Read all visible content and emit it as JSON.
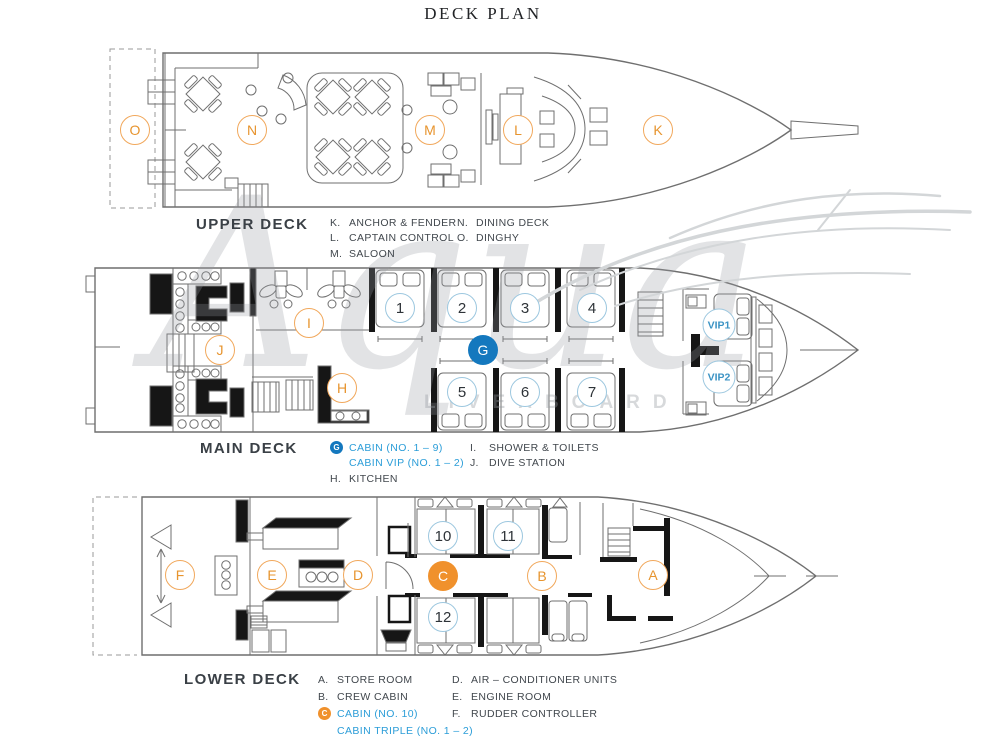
{
  "title": "DECK PLAN",
  "watermark": {
    "brand_script": "Aqua",
    "brand_caps": "LIVEABOARD"
  },
  "colors": {
    "orange_fill": "#F0912C",
    "orange_line": "#F1A85C",
    "orange_text": "#E7942E",
    "blue_fill": "#1478BE",
    "blue_line": "#9CC7DF",
    "blue_text": "#2B9DD8"
  },
  "decks": [
    {
      "id": "upper",
      "label": "UPPER DECK",
      "legend": [
        [
          {
            "key": "K.",
            "text": "ANCHOR & FENDER"
          },
          {
            "key": "L.",
            "text": "CAPTAIN CONTROL"
          },
          {
            "key": "M.",
            "text": "SALOON"
          }
        ],
        [
          {
            "key": "N.",
            "text": "DINING DECK"
          },
          {
            "key": "O.",
            "text": "DINGHY"
          }
        ]
      ],
      "markers": [
        {
          "label": "O",
          "x": 135,
          "y": 130,
          "style": "orange-outline"
        },
        {
          "label": "N",
          "x": 252,
          "y": 130,
          "style": "orange-outline"
        },
        {
          "label": "M",
          "x": 430,
          "y": 130,
          "style": "orange-outline"
        },
        {
          "label": "L",
          "x": 518,
          "y": 130,
          "style": "orange-outline"
        },
        {
          "label": "K",
          "x": 658,
          "y": 130,
          "style": "orange-outline"
        }
      ]
    },
    {
      "id": "main",
      "label": "MAIN DECK",
      "legend": [
        [
          {
            "icon": "G",
            "icon_style": "blue",
            "text": "CABIN (NO. 1 – 9)",
            "blue": true
          },
          {
            "text": "CABIN VIP (NO. 1 – 2)",
            "blue": true
          },
          {
            "key": "H.",
            "text": "KITCHEN"
          }
        ],
        [
          {
            "key": "I.",
            "text": "SHOWER & TOILETS"
          },
          {
            "key": "J.",
            "text": "DIVE STATION"
          }
        ]
      ],
      "markers": [
        {
          "label": "J",
          "x": 220,
          "y": 350,
          "style": "orange-outline"
        },
        {
          "label": "I",
          "x": 309,
          "y": 323,
          "style": "orange-outline"
        },
        {
          "label": "H",
          "x": 342,
          "y": 388,
          "style": "orange-outline"
        },
        {
          "label": "G",
          "x": 483,
          "y": 350,
          "style": "blue-filled"
        },
        {
          "label": "1",
          "x": 400,
          "y": 308,
          "style": "blue-outline"
        },
        {
          "label": "2",
          "x": 462,
          "y": 308,
          "style": "blue-outline"
        },
        {
          "label": "3",
          "x": 525,
          "y": 308,
          "style": "blue-outline"
        },
        {
          "label": "4",
          "x": 592,
          "y": 308,
          "style": "blue-outline"
        },
        {
          "label": "5",
          "x": 462,
          "y": 392,
          "style": "blue-outline"
        },
        {
          "label": "6",
          "x": 525,
          "y": 392,
          "style": "blue-outline"
        },
        {
          "label": "7",
          "x": 592,
          "y": 392,
          "style": "blue-outline"
        },
        {
          "label": "VIP1",
          "x": 719,
          "y": 325,
          "style": "vip"
        },
        {
          "label": "VIP2",
          "x": 719,
          "y": 377,
          "style": "vip"
        }
      ]
    },
    {
      "id": "lower",
      "label": "LOWER DECK",
      "legend": [
        [
          {
            "key": "A.",
            "text": "STORE ROOM"
          },
          {
            "key": "B.",
            "text": "CREW CABIN"
          },
          {
            "icon": "C",
            "icon_style": "orange",
            "text": "CABIN (NO. 10)",
            "blue": true
          },
          {
            "text": "CABIN TRIPLE (NO. 1 – 2)",
            "blue": true
          }
        ],
        [
          {
            "key": "D.",
            "text": "AIR – CONDITIONER UNITS"
          },
          {
            "key": "E.",
            "text": "ENGINE ROOM"
          },
          {
            "key": "F.",
            "text": "RUDDER CONTROLLER"
          }
        ]
      ],
      "markers": [
        {
          "label": "F",
          "x": 180,
          "y": 575,
          "style": "orange-outline"
        },
        {
          "label": "E",
          "x": 272,
          "y": 575,
          "style": "orange-outline"
        },
        {
          "label": "D",
          "x": 358,
          "y": 575,
          "style": "orange-outline"
        },
        {
          "label": "C",
          "x": 443,
          "y": 576,
          "style": "orange-filled"
        },
        {
          "label": "B",
          "x": 542,
          "y": 576,
          "style": "orange-outline"
        },
        {
          "label": "A",
          "x": 653,
          "y": 575,
          "style": "orange-outline"
        },
        {
          "label": "10",
          "x": 443,
          "y": 536,
          "style": "blue-outline"
        },
        {
          "label": "11",
          "x": 508,
          "y": 536,
          "style": "blue-outline"
        },
        {
          "label": "12",
          "x": 443,
          "y": 617,
          "style": "blue-outline"
        }
      ]
    }
  ]
}
